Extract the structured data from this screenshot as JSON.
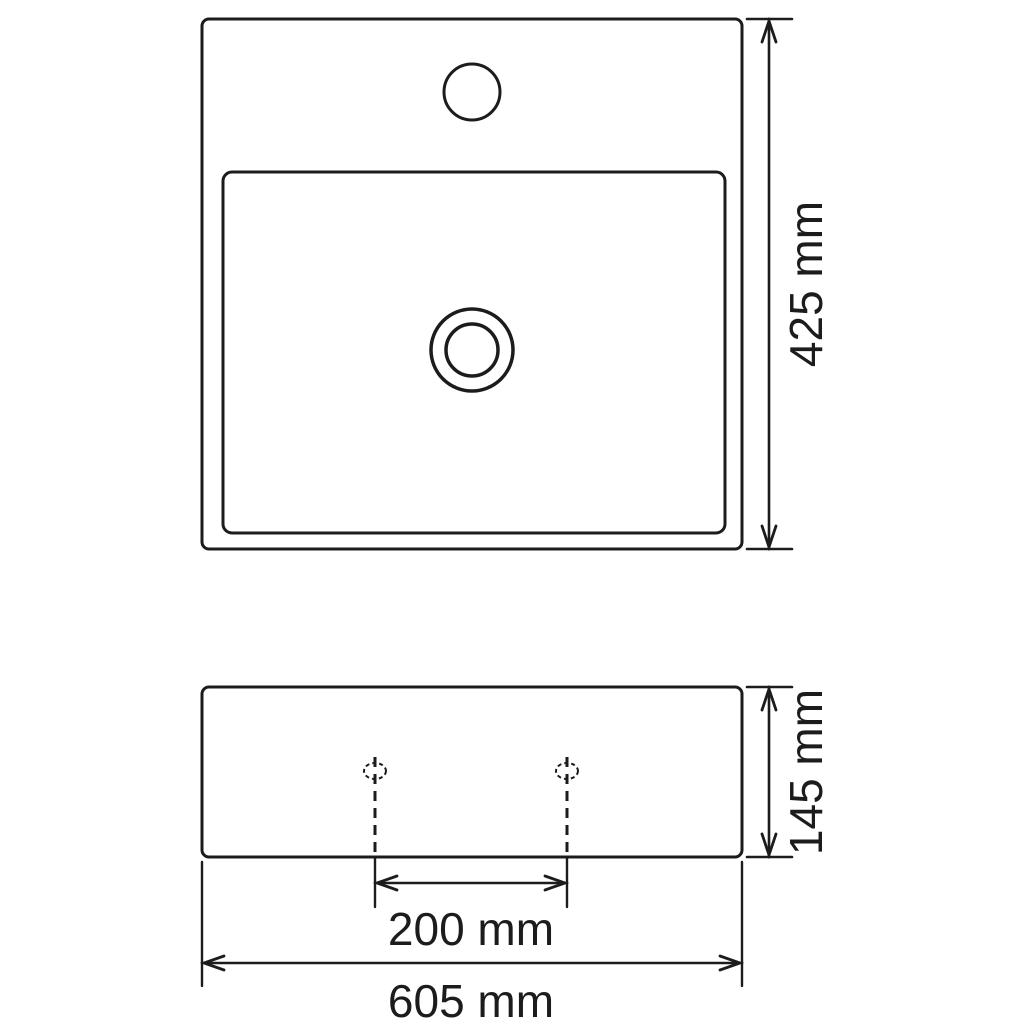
{
  "drawing": {
    "type": "technical-dimension-drawing",
    "subject": "bathroom-basin-with-faucet-hole",
    "background_color": "#ffffff",
    "line_color": "#1c1c1c",
    "dimensions": {
      "height": {
        "label": "425 mm",
        "value_mm": 425
      },
      "depth": {
        "label": "145 mm",
        "value_mm": 145
      },
      "hole_spacing": {
        "label": "200 mm",
        "value_mm": 200
      },
      "width": {
        "label": "605 mm",
        "value_mm": 605
      }
    }
  }
}
